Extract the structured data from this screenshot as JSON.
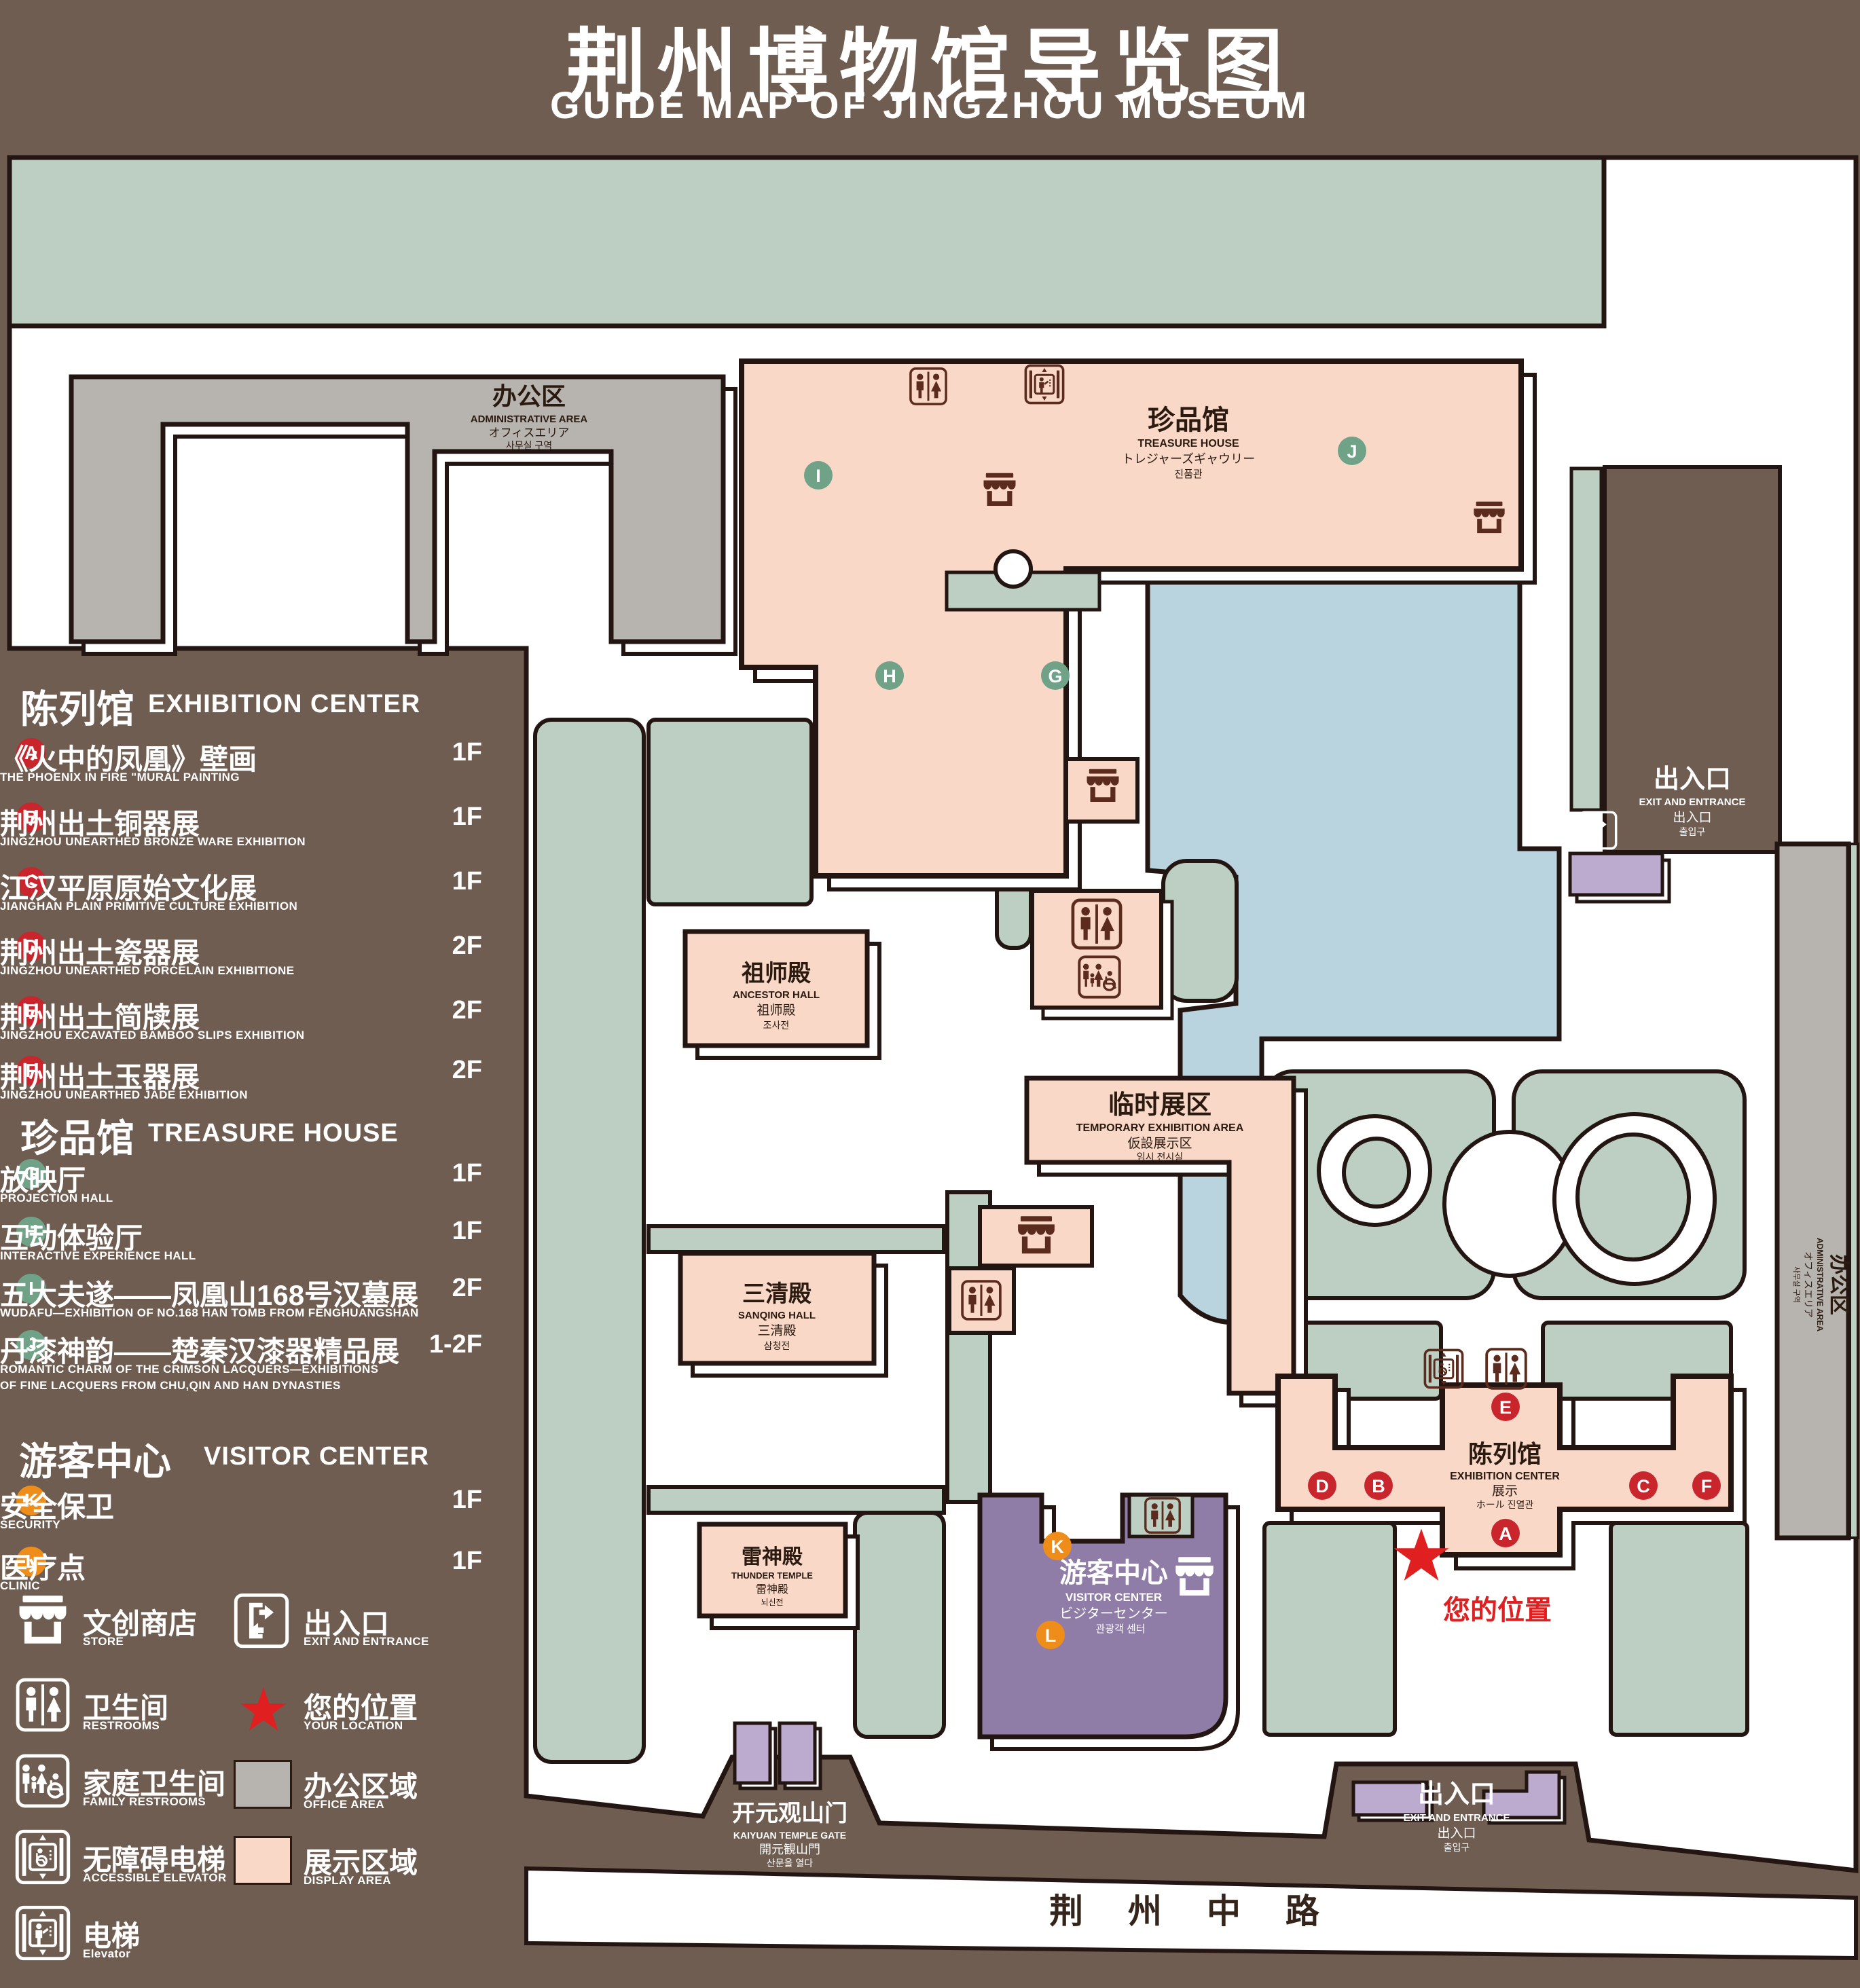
{
  "title": {
    "zh": "荆州博物馆导览图",
    "en": "GUIDE MAP OF JINGZHOU MUSEUM"
  },
  "legend": {
    "sections": [
      {
        "zh": "陈列馆",
        "en": "EXHIBITION CENTER",
        "items": [
          {
            "letter": "A",
            "zh": "《火中的凤凰》壁画",
            "en": "THE PHOENIX IN FIRE \"MURAL PAINTING",
            "floor": "1F"
          },
          {
            "letter": "B",
            "zh": "荆州出土铜器展",
            "en": "JINGZHOU UNEARTHED BRONZE WARE EXHIBITION",
            "floor": "1F"
          },
          {
            "letter": "C",
            "zh": "江汉平原原始文化展",
            "en": "JIANGHAN PLAIN PRIMITIVE CULTURE EXHIBITION",
            "floor": "1F"
          },
          {
            "letter": "D",
            "zh": "荆州出土瓷器展",
            "en": "JINGZHOU UNEARTHED PORCELAIN EXHIBITIONE",
            "floor": "2F"
          },
          {
            "letter": "E",
            "zh": "荆州出土简牍展",
            "en": "JINGZHOU EXCAVATED BAMBOO SLIPS EXHIBITION",
            "floor": "2F"
          },
          {
            "letter": "F",
            "zh": "荆州出土玉器展",
            "en": "JINGZHOU UNEARTHED JADE EXHIBITION",
            "floor": "2F"
          }
        ]
      },
      {
        "zh": "珍品馆",
        "en": "TREASURE HOUSE",
        "items": [
          {
            "letter": "G",
            "zh": "放映厅",
            "en": "PROJECTION HALL",
            "floor": "1F"
          },
          {
            "letter": "H",
            "zh": "互动体验厅",
            "en": "INTERACTIVE EXPERIENCE HALL",
            "floor": "1F"
          },
          {
            "letter": "I",
            "zh": "五大夫遂——凤凰山168号汉墓展",
            "en": "WUDAFU—EXHIBITION OF NO.168 HAN TOMB FROM FENGHUANGSHAN",
            "floor": "2F"
          },
          {
            "letter": "J",
            "zh": "丹漆神韵——楚秦汉漆器精品展",
            "en": "ROMANTIC CHARM OF THE CRIMSON LACQUERS—EXHIBITIONS",
            "en2": "OF FINE LACQUERS FROM CHU,QIN AND HAN DYNASTIES",
            "floor": "1-2F"
          }
        ]
      },
      {
        "zh": "游客中心",
        "en": "VISITOR CENTER",
        "items": [
          {
            "letter": "K",
            "zh": "安全保卫",
            "en": "SECURITY",
            "floor": "1F"
          },
          {
            "letter": "L",
            "zh": "医疗点",
            "en": "CLINIC",
            "floor": "1F"
          }
        ]
      }
    ],
    "symbols": {
      "store": {
        "zh": "文创商店",
        "en": "STORE"
      },
      "exit": {
        "zh": "出入口",
        "en": "EXIT AND ENTRANCE"
      },
      "restrooms": {
        "zh": "卫生间",
        "en": "RESTROOMS"
      },
      "location": {
        "zh": "您的位置",
        "en": "YOUR LOCATION"
      },
      "family": {
        "zh": "家庭卫生间",
        "en": "FAMILY RESTROOMS"
      },
      "office": {
        "zh": "办公区域",
        "en": "OFFICE AREA"
      },
      "accessible": {
        "zh": "无障碍电梯",
        "en": "ACCESSIBLE ELEVATOR"
      },
      "display": {
        "zh": "展示区域",
        "en": "DISPLAY AREA"
      },
      "elevator": {
        "zh": "电梯",
        "en": "Elevator"
      }
    }
  },
  "map": {
    "admin": {
      "zh": "办公区",
      "en": "ADMINISTRATIVE AREA",
      "ja": "オフィスエリア",
      "ko": "사무실 구역"
    },
    "treasure": {
      "zh": "珍品馆",
      "en": "TREASURE HOUSE",
      "ja": "トレジャーズギャウリー",
      "ko": "진품관"
    },
    "ancestor": {
      "zh": "祖师殿",
      "en": "ANCESTOR HALL",
      "ja": "祖师殿",
      "ko": "조사전"
    },
    "temporary": {
      "zh": "临时展区",
      "en": "TEMPORARY EXHIBITION AREA",
      "ja": "仮設展示区",
      "ko": "임시 전시실"
    },
    "sanqing": {
      "zh": "三清殿",
      "en": "SANQING HALL",
      "ja": "三清殿",
      "ko": "삼청전"
    },
    "thunder": {
      "zh": "雷神殿",
      "en": "THUNDER TEMPLE",
      "ja": "雷神殿",
      "ko": "뇌신전"
    },
    "visitor": {
      "zh": "游客中心",
      "en": "VISITOR CENTER",
      "ja": "ビジターセンター",
      "ko": "관광객 센터"
    },
    "exhibition": {
      "zh": "陈列馆",
      "en": "EXHIBITION CENTER",
      "ja": "展示",
      "ko": "ホール 진열관"
    },
    "exit": {
      "zh": "出入口",
      "en": "EXIT AND ENTRANCE",
      "ja": "出入口",
      "ko": "출입구"
    },
    "gate": {
      "zh": "开元观山门",
      "en": "KAIYUAN TEMPLE GATE",
      "ja": "開元観山門",
      "ko": "산문을 열다"
    },
    "road": "荆 州 中 路",
    "your_location": "您的位置",
    "markers": [
      "A",
      "B",
      "C",
      "D",
      "E",
      "F",
      "G",
      "H",
      "I",
      "J",
      "K",
      "L"
    ]
  },
  "colors": {
    "background": "#6e5d50",
    "lawn": "#bccfc2",
    "display_area": "#f9d8c8",
    "office_area": "#b7b3af",
    "pond": "#b9d4de",
    "purple_building": "#bdaacf",
    "visitor_center": "#8f7da7",
    "marker_red": "#c9252c",
    "marker_green": "#6fa287",
    "marker_orange": "#ef8d1b",
    "icon_brown": "#5b2b1d",
    "location_red": "#e02020"
  }
}
